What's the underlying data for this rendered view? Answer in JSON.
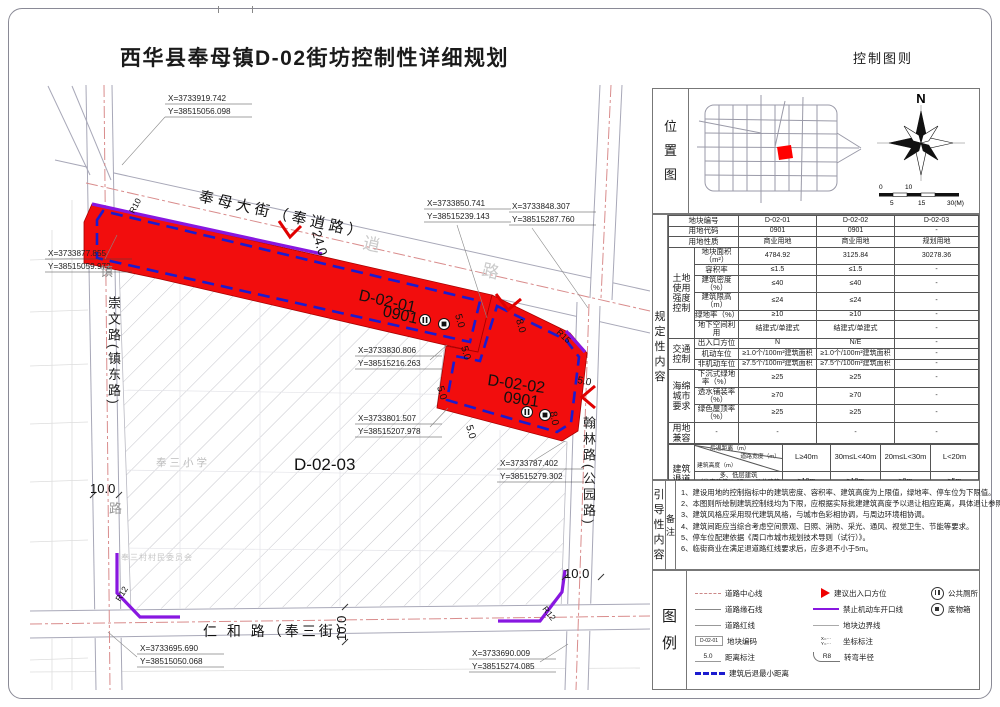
{
  "header": {
    "title": "西华县奉母镇D-02街坊控制性详细规划",
    "sheet_label": "控制图则"
  },
  "location": {
    "label": "位置图",
    "north": "N",
    "scale": [
      "0",
      "10",
      "5",
      "15",
      "30(M)"
    ]
  },
  "reg_label": "规定性内容",
  "main_table": {
    "plain_rows": [
      {
        "label": "地块编号",
        "v": [
          "D-02-01",
          "D-02-02",
          "D-02-03"
        ]
      },
      {
        "label": "用地代码",
        "v": [
          "0901",
          "0901",
          "-"
        ]
      },
      {
        "label": "用地性质",
        "v": [
          "商业用地",
          "商业用地",
          "规划用地"
        ]
      }
    ],
    "groups": [
      {
        "name": "土地使用强度控制",
        "rows": [
          {
            "label": "地块面积（m²）",
            "v": [
              "4784.92",
              "3125.84",
              "30278.36"
            ]
          },
          {
            "label": "容积率",
            "v": [
              "≤1.5",
              "≤1.5",
              "-"
            ]
          },
          {
            "label": "建筑密度（%）",
            "v": [
              "≤40",
              "≤40",
              "-"
            ]
          },
          {
            "label": "建筑限高（m）",
            "v": [
              "≤24",
              "≤24",
              "-"
            ]
          },
          {
            "label": "绿地率（%）",
            "v": [
              "≥10",
              "≥10",
              "-"
            ]
          },
          {
            "label": "地下空间利用",
            "v": [
              "结建式/单建式",
              "结建式/单建式",
              "-"
            ]
          }
        ]
      },
      {
        "name": "交通控制",
        "rows": [
          {
            "label": "出入口方位",
            "v": [
              "N",
              "N/E",
              "-"
            ]
          },
          {
            "label": "机动车位",
            "v": [
              "≥1.0个/100m²建筑面积",
              "≥1.0个/100m²建筑面积",
              "-"
            ]
          },
          {
            "label": "非机动车位",
            "v": [
              "≥7.5个/100m²建筑面积",
              "≥7.5个/100m²建筑面积",
              "-"
            ]
          }
        ]
      },
      {
        "name": "海绵城市要求",
        "rows": [
          {
            "label": "下沉式绿地率（%）",
            "v": [
              "≥25",
              "≥25",
              "-"
            ]
          },
          {
            "label": "透水铺装率（%）",
            "v": [
              "≥70",
              "≥70",
              "-"
            ]
          },
          {
            "label": "绿色屋顶率（%）",
            "v": [
              "≥25",
              "≥25",
              "-"
            ]
          }
        ]
      }
    ],
    "compat": {
      "name": "用地兼容",
      "cells": [
        "-",
        "-",
        "-",
        "-"
      ]
    }
  },
  "setback": {
    "group_label": "建筑退道路红线控制距离",
    "corner": {
      "a": "后退距离（m）",
      "b": "道路宽度（m）",
      "c": "建筑高度（m）"
    },
    "cols": [
      "L≥40m",
      "30m≤L<40m",
      "20m≤L<30m",
      "L<20m"
    ],
    "rows": [
      {
        "label": "多、低层建筑\n（住宅建筑H≤27m、公共建筑和工业建筑H≤24m）",
        "values": [
          "≥10m",
          "≥10m",
          "≥8m",
          "≥5m"
        ]
      },
      {
        "label": "二类高层建筑\n（住宅建筑27m<H≤54m、公共建筑和\n工业建筑24m<H≤50m）",
        "values": [
          "≥15m",
          "≥12m",
          "≥10m",
          "≥8m"
        ]
      },
      {
        "label": "一类高层建筑\n（住宅建筑H>54m、公共建筑和工业建筑H>50m）",
        "values": [
          "≥20m",
          "≥15m",
          "≥12m",
          "≥10m"
        ]
      }
    ]
  },
  "notes": {
    "label": "引导性内容",
    "remark": "备注",
    "items": [
      "1、建设用地的控制指标中的建筑密度、容积率、建筑高度为上限值，绿地率、停车位为下限值。",
      "2、本图则所绘制建筑控制线均为下限，应根据实际批建建筑高度予以退让相应距离，具体退让参照文本。",
      "3、建筑风格应采用现代建筑风格，与城市色彩相协调，与周边环境相协调。",
      "4、建筑间距应当综合考虑空间景观、日照、消防、采光、通风、视觉卫生、节能等要求。",
      "5、停车位配建依据《周口市城市规划技术导则（试行）》。",
      "6、临街商业在满足退道路红线要求后，应多退不小于5m。"
    ]
  },
  "legend": {
    "label": "图例",
    "cols": [
      [
        {
          "type": "centerline",
          "label": "道路中心线"
        },
        {
          "type": "curbline",
          "label": "道路缘石线"
        },
        {
          "type": "redline",
          "label": "道路红线"
        },
        {
          "type": "blockcode",
          "label": "地块编码",
          "sample": "D-02-01"
        },
        {
          "type": "dim",
          "label": "距离标注",
          "sample": "5.0"
        },
        {
          "type": "setback",
          "label": "建筑后退最小距离"
        }
      ],
      [
        {
          "type": "arrow",
          "label": "建议出入口方位"
        },
        {
          "type": "purple",
          "label": "禁止机动车开口线"
        },
        {
          "type": "boundary",
          "label": "地块边界线"
        },
        {
          "type": "coord",
          "label": "坐标标注",
          "sample": "X=···\nY=···"
        },
        {
          "type": "radius",
          "label": "转弯半径",
          "sample": "R8"
        }
      ],
      [
        {
          "type": "toilet",
          "label": "公共厕所"
        },
        {
          "type": "bin",
          "label": "废物箱"
        }
      ]
    ]
  },
  "map": {
    "roads": {
      "main": "奉母大街（奉逍路）",
      "west": "崇文路(镇东路)",
      "east": "翰林路(公园路)",
      "south": "仁 和 路（奉三街）",
      "faint_xiao": "逍",
      "faint_lu": "路",
      "west_top": "镇",
      "west_bottom": "路"
    },
    "school": "奉三小学",
    "committee": "奉三村村民委员会",
    "parcels": {
      "p1_code": "D-02-01",
      "p1_use": "0901",
      "p2_code": "D-02-02",
      "p2_use": "0901",
      "p3_code": "D-02-03"
    },
    "dims": {
      "d24": "24.0",
      "d10": "10.0",
      "d5": "5.0",
      "d8": "8.0"
    },
    "radii": {
      "r10": "R10",
      "r15": "R15",
      "r12": "R12"
    },
    "coords": [
      {
        "x": "X=3733919.742",
        "y": "Y=38515056.098"
      },
      {
        "x": "X=3733850.741",
        "y": "Y=38515239.143"
      },
      {
        "x": "X=3733848.307",
        "y": "Y=38515287.760"
      },
      {
        "x": "X=3733877.855",
        "y": "Y=38515059.972"
      },
      {
        "x": "X=3733830.806",
        "y": "Y=38515216.263"
      },
      {
        "x": "X=3733801.507",
        "y": "Y=38515207.978"
      },
      {
        "x": "X=3733787.402",
        "y": "Y=38515279.302"
      },
      {
        "x": "X=3733695.690",
        "y": "Y=38515050.068"
      },
      {
        "x": "X=3733690.009",
        "y": "Y=38515274.085"
      }
    ]
  }
}
